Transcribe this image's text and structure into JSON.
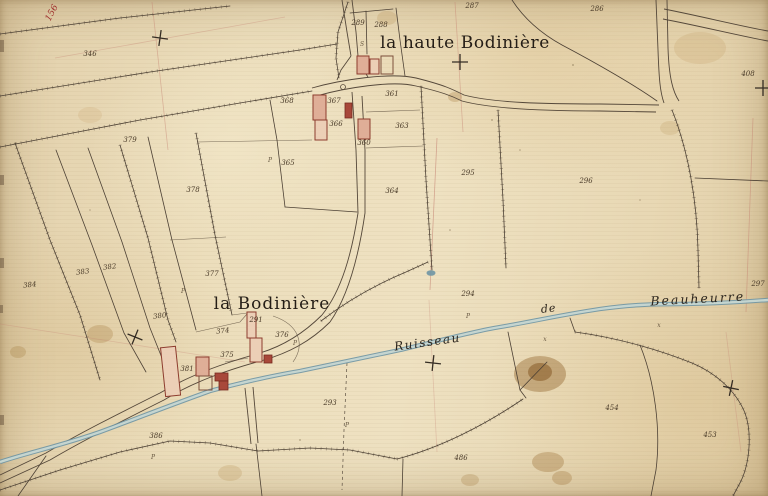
{
  "map": {
    "type": "historic-cadastral-map",
    "place_labels": [
      {
        "text": "la haute Bodinière",
        "x": 465,
        "y": 48,
        "size": 17,
        "ls": 0.6
      },
      {
        "text": "la Bodinière",
        "x": 272,
        "y": 309,
        "size": 17,
        "ls": 1
      }
    ],
    "stream_labels": [
      {
        "text": "Ruisseau",
        "x": 428,
        "y": 346,
        "rot": -8,
        "size": 12,
        "ls": 1.5
      },
      {
        "text": "de",
        "x": 549,
        "y": 312,
        "rot": -6,
        "size": 11,
        "ls": 1
      },
      {
        "text": "Beauheurre",
        "x": 698,
        "y": 303,
        "rot": -3,
        "size": 12.5,
        "ls": 2
      }
    ],
    "red_label": {
      "text": "156",
      "x": 54,
      "y": 14,
      "rot": -62
    },
    "parcel_numbers": [
      {
        "n": "346",
        "x": 90,
        "y": 56
      },
      {
        "n": "379",
        "x": 130,
        "y": 142
      },
      {
        "n": "378",
        "x": 193,
        "y": 192
      },
      {
        "n": "384",
        "x": 30,
        "y": 287,
        "r": -6
      },
      {
        "n": "383",
        "x": 83,
        "y": 274,
        "r": -8
      },
      {
        "n": "382",
        "x": 110,
        "y": 269,
        "r": -8
      },
      {
        "n": "377",
        "x": 212,
        "y": 276
      },
      {
        "n": "380",
        "x": 160,
        "y": 318,
        "r": -8
      },
      {
        "n": "381",
        "x": 187,
        "y": 371
      },
      {
        "n": "386",
        "x": 156,
        "y": 438
      },
      {
        "n": "375",
        "x": 227,
        "y": 357
      },
      {
        "n": "374",
        "x": 223,
        "y": 333,
        "r": -6
      },
      {
        "n": "376",
        "x": 282,
        "y": 337
      },
      {
        "n": "291",
        "x": 256,
        "y": 322
      },
      {
        "n": "293",
        "x": 330,
        "y": 405
      },
      {
        "n": "486",
        "x": 461,
        "y": 460
      },
      {
        "n": "454",
        "x": 612,
        "y": 410
      },
      {
        "n": "453",
        "x": 710,
        "y": 437
      },
      {
        "n": "294",
        "x": 468,
        "y": 296
      },
      {
        "n": "295",
        "x": 468,
        "y": 175
      },
      {
        "n": "296",
        "x": 586,
        "y": 183
      },
      {
        "n": "297",
        "x": 758,
        "y": 286
      },
      {
        "n": "289",
        "x": 358,
        "y": 25
      },
      {
        "n": "288",
        "x": 381,
        "y": 27
      },
      {
        "n": "287",
        "x": 472,
        "y": 8
      },
      {
        "n": "286",
        "x": 597,
        "y": 11
      },
      {
        "n": "408",
        "x": 748,
        "y": 76
      },
      {
        "n": "361",
        "x": 392,
        "y": 96
      },
      {
        "n": "367",
        "x": 334,
        "y": 103
      },
      {
        "n": "368",
        "x": 287,
        "y": 103
      },
      {
        "n": "366",
        "x": 336,
        "y": 126
      },
      {
        "n": "363",
        "x": 402,
        "y": 128
      },
      {
        "n": "360",
        "x": 364,
        "y": 145
      },
      {
        "n": "365",
        "x": 288,
        "y": 165
      },
      {
        "n": "364",
        "x": 392,
        "y": 193
      }
    ],
    "crosses": [
      {
        "x": 160,
        "y": 38,
        "r": 8
      },
      {
        "x": 460,
        "y": 62,
        "r": 0
      },
      {
        "x": 763,
        "y": 88,
        "r": 0
      },
      {
        "x": 135,
        "y": 337,
        "r": 22
      },
      {
        "x": 433,
        "y": 363,
        "r": 6
      },
      {
        "x": 731,
        "y": 388,
        "r": 12
      }
    ],
    "marks": [
      {
        "t": "P",
        "x": 183,
        "y": 293
      },
      {
        "t": "P",
        "x": 468,
        "y": 318
      },
      {
        "t": "x",
        "x": 659,
        "y": 327
      },
      {
        "t": "P",
        "x": 347,
        "y": 427
      },
      {
        "t": "P",
        "x": 153,
        "y": 459
      },
      {
        "t": "P",
        "x": 295,
        "y": 345
      },
      {
        "t": "S",
        "x": 362,
        "y": 46
      },
      {
        "t": "P",
        "x": 270,
        "y": 162
      },
      {
        "t": "x",
        "x": 545,
        "y": 341
      }
    ],
    "colors": {
      "paper": "#ecdebc",
      "ink": "#4c4034",
      "water": "#6e95a4",
      "building_fill": "#dfae97",
      "building_stroke": "#8d3c2e",
      "red_accent": "#a03330",
      "construction_line": "#c37f6f"
    }
  }
}
